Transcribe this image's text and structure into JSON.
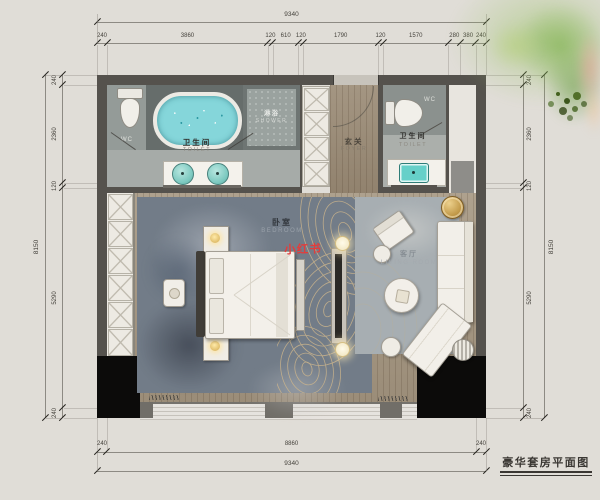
{
  "title": "豪华套房平面图",
  "watermark": "小红书",
  "colors": {
    "wall": "#55524d",
    "accent_red": "#e23d3c",
    "tub_water": "#85d6da",
    "basin_teal": "#66d0c9",
    "gold": "#c9a050",
    "rug_blue": "#727c88"
  },
  "rooms": {
    "toilet_left": {
      "zh": "卫生间",
      "en": "TOILET"
    },
    "shower": {
      "zh": "淋浴",
      "en": "SHOWER"
    },
    "wc_left": "WC",
    "foyer": {
      "zh": "玄关",
      "en": "FOYER"
    },
    "toilet_right": {
      "zh": "卫生间",
      "en": "TOILET"
    },
    "wc_right": "WC",
    "bedroom": {
      "zh": "卧室",
      "en": "BEDROOM"
    },
    "wardrobe": {
      "zh": "衣帽间",
      "en": "WARDROBE"
    },
    "living_room": {
      "zh": "客厅",
      "en": "LIVING ROOM"
    }
  },
  "dimensions": {
    "top": {
      "total": "9340",
      "segments": [
        "240",
        "3860",
        "120",
        "610",
        "120",
        "1790",
        "120",
        "1570",
        "280",
        "380",
        "240"
      ]
    },
    "bottom": {
      "total": "9340",
      "segments": [
        "240",
        "8860",
        "240"
      ]
    },
    "left": {
      "total": "8150",
      "segments": [
        "240",
        "2360",
        "120",
        "5290",
        "240"
      ]
    },
    "right": {
      "total": "8150",
      "segments": [
        "240",
        "2360",
        "120",
        "5290",
        "240"
      ]
    }
  }
}
